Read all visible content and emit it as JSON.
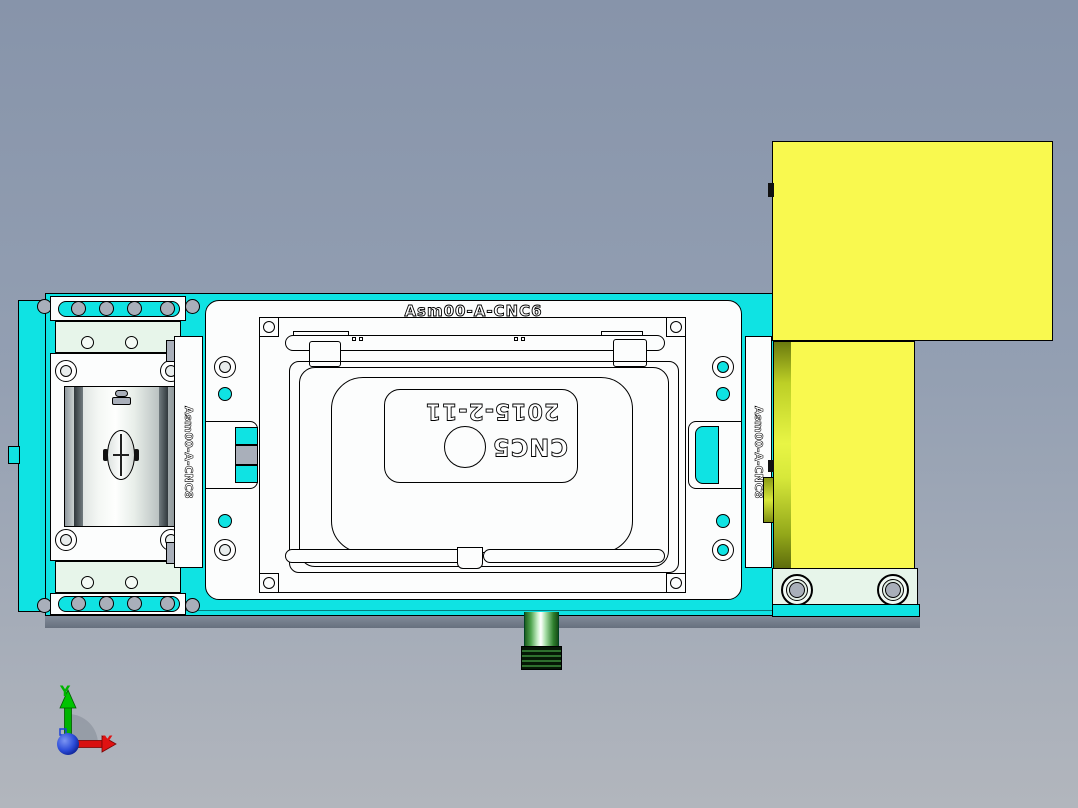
{
  "viewport": {
    "type": "3d-cad-view"
  },
  "model": {
    "assembly_label_top": "Asm00-A-CNC6",
    "side_label_left": "Asm00-A-CNC8",
    "side_label_right": "Asm00-A-CNC8",
    "nest_plate": {
      "date_marking": "2015-2-11",
      "machine_marking": "CNC5"
    }
  },
  "axis_triad": {
    "x_label": "X",
    "y_label": "Y",
    "x_color": "#E01212",
    "y_color": "#00B400",
    "origin_color": "#1B3FD8"
  },
  "colors": {
    "base_plate_cyan": "#0FE3E3",
    "block_yellow": "#F9F94F",
    "plate_white": "#FCFDFD",
    "plate_pale_green": "#E7F5EA",
    "roller_gray": "#A9AFBA",
    "plug_green": "#3FA93F",
    "shadow_gray": "#6E7887",
    "background_top": "#8794AA",
    "background_bottom": "#B2B6BD"
  }
}
